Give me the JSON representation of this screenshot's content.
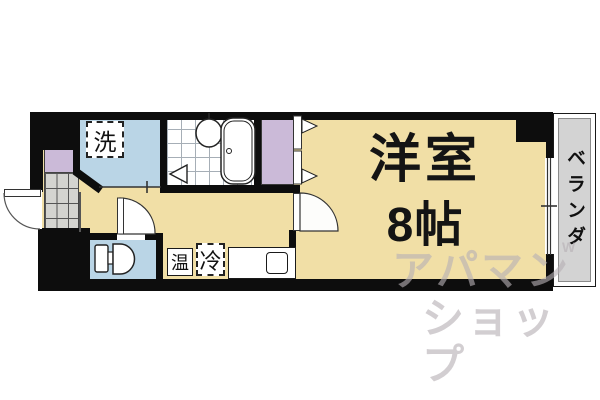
{
  "rooms": {
    "main": {
      "name": "洋室",
      "size": "8帖"
    },
    "balcony_label": "ベランダ"
  },
  "fixtures": {
    "washer_label": "洗",
    "hot_label": "温",
    "cold_label": "冷"
  },
  "watermark": {
    "line1": "アパマン",
    "line2": "ショップ",
    "mark": "W"
  },
  "colors": {
    "room_floor": "#F1DFA6",
    "wet_area": "#BAD5E6",
    "closet": "#CBBAD8",
    "balcony": "#D3D3D3",
    "genkan_tile": "#D4D4D0",
    "wall": "#0D0D0D",
    "watermark": "rgba(182,176,180,0.62)"
  }
}
